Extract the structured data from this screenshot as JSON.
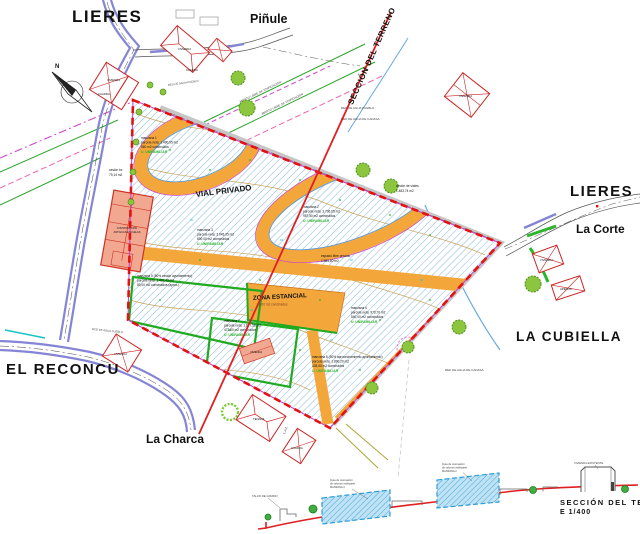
{
  "canvas": {
    "width": 640,
    "height": 534
  },
  "colors": {
    "boundary_red": "#E31212",
    "road_orange": "#F3A73B",
    "hatch_blue": "#86B8DC",
    "road_purple": "#8585D6",
    "line_green": "#2AA52A",
    "line_magenta": "#CC44CC",
    "tree_green": "#8CC63E",
    "text_brown": "#7D3A28",
    "text_green": "#2DB52D",
    "terrain_red": "#E02020",
    "section_gray": "#9A9A9A"
  },
  "place_labels": {
    "lieres_top": "LIERES",
    "pinule": "Piñule",
    "lieres_right": "LIERES",
    "la_corte": "La Corte",
    "la_cubiella": "LA CUBIELLA",
    "el_reconcu": "EL RECONCU",
    "la_charca": "La Charca"
  },
  "section_line": {
    "label": "SECCIÓN DEL TERRENO"
  },
  "compass": {
    "label": "N"
  },
  "road_labels": {
    "vial_privado": "VIAL PRIVADO"
  },
  "zones": {
    "zona_estancial": {
      "title": "ZONA ESTANCIAL",
      "detail": "20,00 m2 construidos"
    },
    "espacio_libre": {
      "lines": [
        "espacio libre privado",
        "1.985,60 m2"
      ]
    },
    "cesion_viales": {
      "lines": [
        "cesión de viales",
        "1.483,74 m2"
      ]
    },
    "cesion_bz": {
      "lines": [
        "cesión bz",
        "79,14 m2"
      ]
    },
    "manzanas": [
      {
        "lines": [
          "manzana 1",
          "parcela neta: 1.490,95 m2",
          "560 m2 construidos"
        ],
        "uso": "U. UNIFAMILIAR"
      },
      {
        "lines": [
          "manzana 2",
          "parcela neta: 3.736,05 m2",
          "957,50 m2 construidos"
        ],
        "uso": "U. UNIFAMILIAR"
      },
      {
        "lines": [
          "manzana 3",
          "parcela neta: 2.045,35 m2",
          "690,00 m2 construidos"
        ],
        "uso": "U. UNIFAMILIAR"
      },
      {
        "lines": [
          "manzana 4",
          "parcela neta: 973,70 m2",
          "540,00 m2 construidos"
        ],
        "uso": "U. UNIFAMILIAR"
      },
      {
        "lines": [
          "manzana 5 (50% cesión ayuntamiento)",
          "parcela neta: 1.492,43 m2",
          "50,00 m2 construidos (aprox.)"
        ],
        "uso": ""
      },
      {
        "lines": [
          "manzana 6 (50% aprovechamiento ayuntamiento)",
          "parcela neta: 1.890,20 m2",
          "435,50 m2 construidos"
        ],
        "uso": "U. UNIFAMILIAR"
      },
      {
        "lines": [
          "manzana 7",
          "parcela neta: 1.677,56 m2",
          "473,00 m2 construidos"
        ],
        "uso": "U. UNIFAMILIAR"
      }
    ]
  },
  "buildings": {
    "vivienda_top": "VIVIENDA",
    "cuadra_top": "CUADRA",
    "vivienda_topleft": "VIVIENDA",
    "cuadra_topleft": "CUADRA",
    "vivienda_topright": "VIVIENDA",
    "vivienda_right": "VIVIENDA",
    "aperos_right": "APEROS",
    "vivienda_west": "VIVIENDA",
    "tenada_south": "TENADA",
    "cuadra_south": "CUADRA",
    "vivienda_parcela": "VIVIENDA",
    "escuelas": {
      "lines": [
        "CONSTRUCCIÓN",
        "ANTIGUAS ESCUELAS"
      ]
    }
  },
  "infrastructure": {
    "red_agua_pueblo": "RED DE AGUA PUEBLO",
    "red_agua_cadasa": "RED DE AGUA DE CADASA",
    "ambito_libre": "ÁMBITO LIBRE DE EDIFICACIÓN",
    "la2": "L.A.2"
  },
  "section_view": {
    "title_line1": "SECCIÓN DEL TERRENO",
    "title_line2": "E 1/400",
    "volume1_label": [
      "línea de coronación",
      "de volumen edificable",
      "MANZANA 3"
    ],
    "volume2_label": [
      "línea de coronación",
      "de volumen edificable",
      "MANZANA 2"
    ],
    "house_label": "VIVIENDA EXISTENTE",
    "wall_label": "TALUD DE CAMINO"
  }
}
